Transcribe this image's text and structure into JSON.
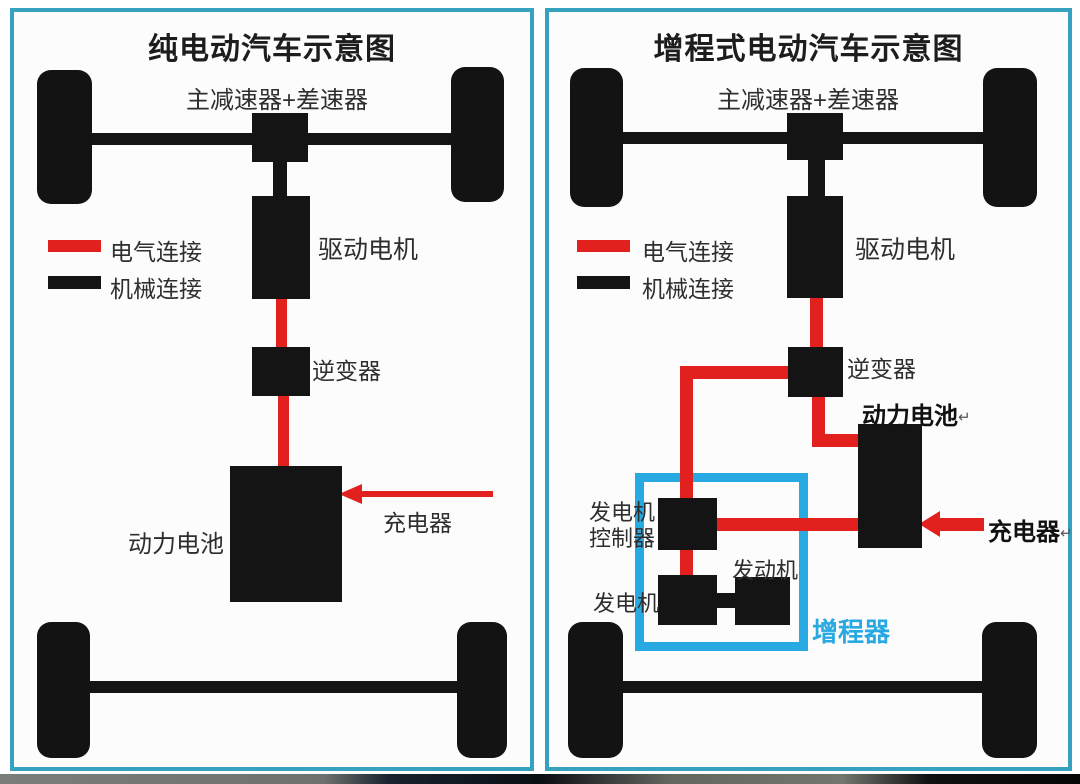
{
  "colors": {
    "panel_border": "#36a2bf",
    "range_extender_blue": "#29a9e1",
    "electrical_red": "#e2201d",
    "mechanical_black": "#141414"
  },
  "left_panel": {
    "title": "纯电动汽车示意图",
    "labels": {
      "reducer": "主减速器+差速器",
      "drive_motor": "驱动电机",
      "inverter": "逆变器",
      "battery": "动力电池",
      "charger": "充电器"
    },
    "legend": {
      "electrical": "电气连接",
      "mechanical": "机械连接"
    }
  },
  "right_panel": {
    "title": "增程式电动汽车示意图",
    "labels": {
      "reducer": "主减速器+差速器",
      "drive_motor": "驱动电机",
      "inverter": "逆变器",
      "battery": "动力电池",
      "battery_return_mark": "↵",
      "charger": "充电器",
      "charger_return_mark": "↵",
      "gen_controller_line1": "发电机",
      "gen_controller_line2": "控制器",
      "generator": "发电机",
      "engine": "发动机",
      "range_extender": "增程器"
    },
    "legend": {
      "electrical": "电气连接",
      "mechanical": "机械连接"
    }
  }
}
